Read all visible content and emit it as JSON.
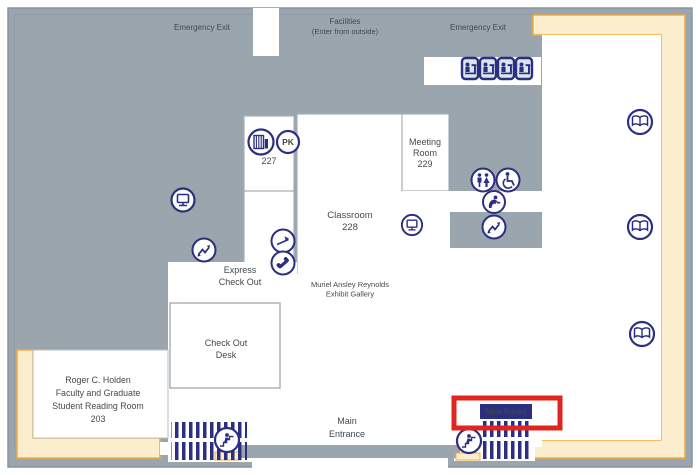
{
  "colors": {
    "floor_gray": "#9aa5ad",
    "wall_line": "#8795a1",
    "room_white": "#ffffff",
    "room_border": "#a6afb7",
    "zone_yellow": "#faeecd",
    "zone_yellow_border": "#f3a93e",
    "icon_navy": "#2b2f82",
    "highlight_red": "#e0241f",
    "text_gray": "#46484b"
  },
  "labels": {
    "emergency_exit_left": "Emergency Exit",
    "facilities_line1": "Facilities",
    "facilities_line2": "(Enter from outside)",
    "emergency_exit_right": "Emergency Exit",
    "room_227": "227",
    "pk_badge": "PK",
    "meeting_room": [
      "Meeting",
      "Room",
      "229"
    ],
    "classroom": [
      "Classroom",
      "228"
    ],
    "express_checkout": [
      "Express",
      "Check Out"
    ],
    "exhibit_gallery": [
      "Muriel Ansley Reynolds",
      "Exhibit Gallery"
    ],
    "checkout_desk": [
      "Check Out",
      "Desk"
    ],
    "reading_room": [
      "Roger C. Holden",
      "Faculty and Graduate",
      "Student Reading Room",
      "203"
    ],
    "main_entrance": [
      "Main",
      "Entrance"
    ],
    "new_books": "New Books"
  },
  "icons": [
    "book-stack-icon",
    "pk-icon",
    "computer-icon",
    "computer-icon",
    "book-drop-icon",
    "telephone-icon",
    "stairs-direction-icon",
    "stairs-direction-icon",
    "workstation-icon",
    "workstation-icon",
    "workstation-icon",
    "workstation-icon",
    "restroom-icon",
    "wheelchair-access-icon",
    "drinking-fountain-icon",
    "open-book-icon",
    "open-book-icon",
    "open-book-icon",
    "stairs-icon",
    "stairs-icon"
  ],
  "annotation": {
    "highlight_box_target": "New Books"
  }
}
